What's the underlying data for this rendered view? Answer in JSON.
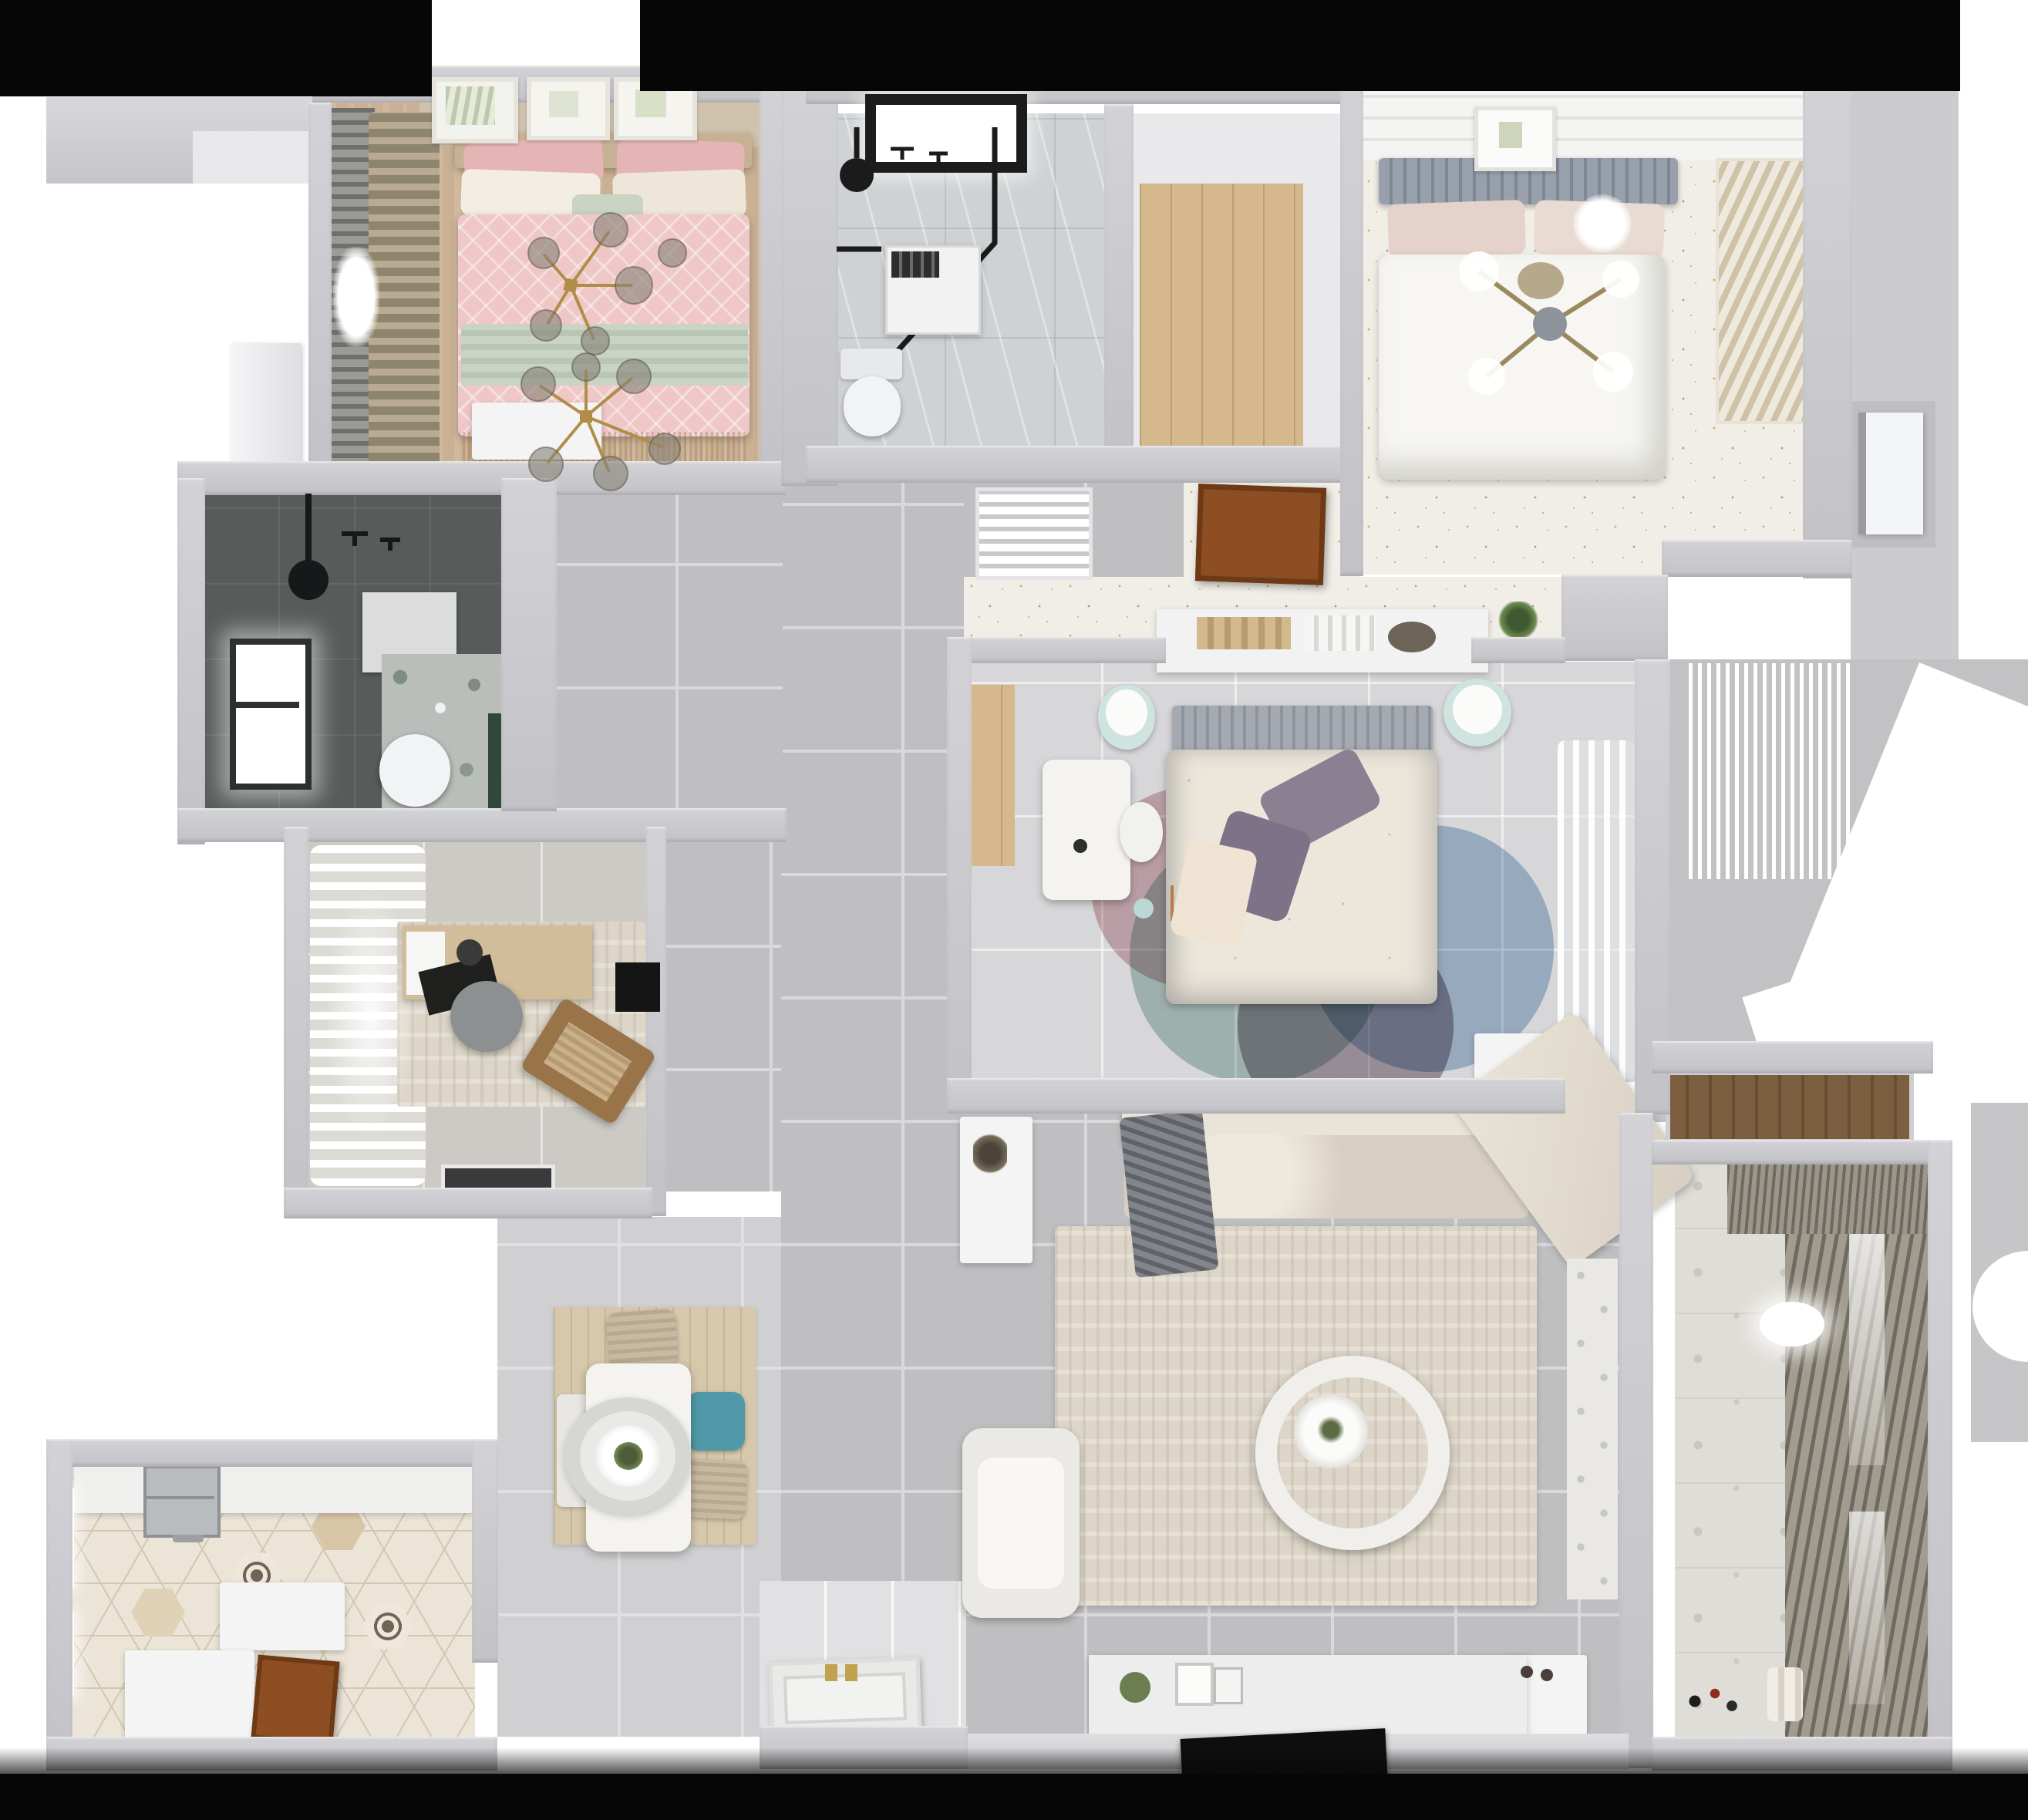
{
  "scene": {
    "kind": "3d-floorplan-top-down-render",
    "description": "Photorealistic dollhouse-style top view of a 3-bedroom apartment",
    "background": "white with black bands at top corners and bottom edge",
    "no_visible_text": true
  },
  "palette": {
    "bg_black": "#060606",
    "bg_white": "#ffffff",
    "wall": "#c8c8cc",
    "wall_dark": "#b4b4b8",
    "hall_floor": "#bfbfc1",
    "hall_grout": "#d9d9db",
    "living_floor": "#c2c2c4",
    "master_floor": "#d7d7d9",
    "study_floor": "#cdc9c4",
    "entry_floor": "#e1e1e3",
    "dining_floor": "#d0d0d2",
    "confetti_base": "#f1eee7",
    "confetti_gold": "#d2ae5e",
    "confetti_teal": "#88aab0",
    "confetti_gray": "#b5b5b5",
    "wood_pink_floor": "#cbb193",
    "wood_closet": "#d5b88b",
    "wood_rug": "#d7c8ac",
    "dark_bath": "#575c5a",
    "green_accent": "#31473a",
    "marble": "#cfd2d4",
    "hex_base": "#ebe4d7",
    "hex_line": "#d3c7b2",
    "hex_tan": "#d9c6a6",
    "motif_dark": "#6f6557",
    "balcony_floor": "#dfddd7",
    "shutter": "#a29c90",
    "shutter_dark": "#6f6a60",
    "sofa": "#d7cfc1",
    "sofa_light": "#eae4d8",
    "throw_gray": "#82868c",
    "rug_living": "#ddd6c8",
    "armchair": "#ebe9e5",
    "console": "#ededee",
    "tv_black": "#0e0e0e",
    "table_white": "#f4f3f0",
    "teal": "#4f99a8",
    "chair_beige": "#c7b9a2",
    "bench_white": "#e9e7e3",
    "bed_pink": "#efc7c7",
    "bed_pink_deep": "#e5b4b4",
    "sage": "#c9d4c4",
    "pillow_cream": "#f4ede3",
    "headboard_tan": "#c7b194",
    "gold": "#b08e47",
    "master_duvet": "#ece6db",
    "master_pillow": "#8b7f92",
    "headboard_gray": "#a5aab2",
    "pouf_teal": "#cfe3df",
    "rug_pink": "#c4939b",
    "rug_blue": "#84a7c9",
    "rug_teal": "#93b5ae",
    "rug_plum": "#836f7d",
    "white_bed": "#f7f6f3",
    "headboard_slate": "#98a1ab",
    "blush": "#e5d3cb",
    "door_brown": "#8e4e22",
    "door_brown_dark": "#6e3a16",
    "steel": "#b9bcbe",
    "toilet": "#f2f3f4",
    "vent_white": "#e9e9eb",
    "shelf_white": "#f2f2f3"
  },
  "rooms": [
    {
      "id": "bedroom-pink",
      "area": "top-left",
      "items": [
        "wall art frames x3",
        "window curtains",
        "double bed pink bedding",
        "sage throw",
        "gold branch chandelier",
        "foot bench"
      ]
    },
    {
      "id": "bathroom-dark",
      "area": "mid-left",
      "items": [
        "bright window",
        "black shower set",
        "wall towel panel",
        "marble accent wall",
        "toilet",
        "green accent strip"
      ]
    },
    {
      "id": "study",
      "area": "center-left",
      "items": [
        "white drape wall",
        "desk",
        "gray round chair",
        "wood lounge chair",
        "textured rug",
        "black tablet",
        "dark doormat"
      ]
    },
    {
      "id": "kitchen",
      "area": "bottom-left",
      "items": [
        "hex tile floor",
        "double steel sink",
        "white counters",
        "island",
        "wood entry door",
        "windows"
      ]
    },
    {
      "id": "dining",
      "area": "bottom-center-left",
      "items": [
        "wood rug",
        "white table",
        "ring pendant lamp",
        "plant centerpiece",
        "teal chair",
        "two beige chairs",
        "white bench"
      ]
    },
    {
      "id": "bathroom-main",
      "area": "top-center",
      "items": [
        "skylight window",
        "black framed shower",
        "shower head",
        "water heater unit",
        "toilet"
      ]
    },
    {
      "id": "closet-hall",
      "area": "top-center-right",
      "items": [
        "wood plank floor"
      ]
    },
    {
      "id": "bedroom-white",
      "area": "top-right",
      "items": [
        "plank ceiling strip",
        "art frame",
        "slatted gray headboard",
        "white duvet",
        "cross ceiling fan",
        "louvered wardrobe",
        "confetti floor"
      ]
    },
    {
      "id": "corridor",
      "area": "center",
      "items": [
        "gray tile floor",
        "floor vent grille",
        "open wood door",
        "confetti strip",
        "white console shelf with books and plant"
      ]
    },
    {
      "id": "bedroom-master",
      "area": "center-right",
      "items": [
        "gray headboard",
        "floral duvet",
        "purple pillows",
        "two teal poufs",
        "white desk and chair",
        "wood closet strip",
        "overlapping circle rug",
        "sheer curtains",
        "white dresser"
      ]
    },
    {
      "id": "living-room",
      "area": "bottom-center-right",
      "items": [
        "L sofa",
        "gray throw",
        "side table",
        "cream rug",
        "round ring coffee table",
        "white armchair",
        "tv console with decor",
        "black tv panel",
        "patterned tile strip"
      ]
    },
    {
      "id": "entry",
      "area": "bottom-center",
      "items": [
        "open white paneled door with gold handles",
        "stone floor"
      ]
    },
    {
      "id": "balcony",
      "area": "bottom-right",
      "items": [
        "patterned tile floor",
        "louvered shutters",
        "ceiling light",
        "toys",
        "paint rolls",
        "wood cabinet"
      ]
    }
  ]
}
